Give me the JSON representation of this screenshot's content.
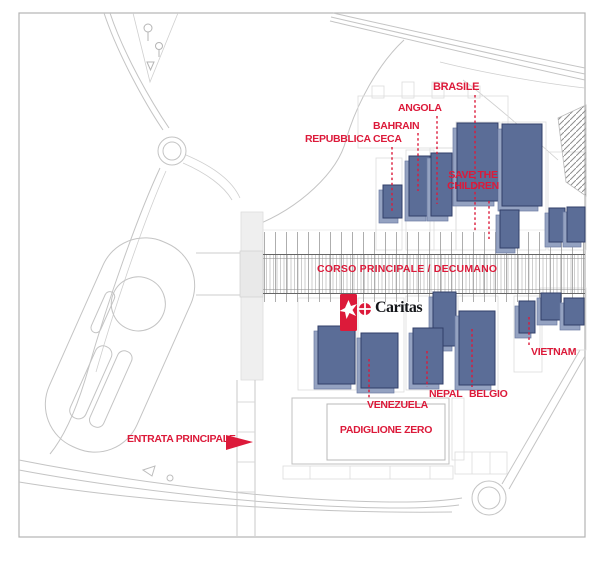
{
  "map": {
    "title_context": "Expo site plan",
    "labels": {
      "brasile": "BRASILE",
      "angola": "ANGOLA",
      "bahrain": "BAHRAIN",
      "repubblica_ceca": "REPUBBLICA CECA",
      "save_the_children": "SAVE THE CHILDREN",
      "corso_principale": "CORSO PRINCIPALE / DECUMANO",
      "vietnam": "VIETNAM",
      "nepal": "NEPAL",
      "belgio": "BELGIO",
      "venezuela": "VENEZUELA",
      "padiglione_zero": "PADIGLIONE ZERO",
      "entrata_principale": "ENTRATA PRINCIPALE",
      "caritas_logo": "Caritas"
    },
    "icons": {
      "caritas_marker": "dove-icon",
      "caritas_emblem": "caritas-cross-icon",
      "entrance_arrow": "arrow-right-icon"
    },
    "colors": {
      "label_red": "#dc1a3a",
      "building_fill": "#5b6d97",
      "building_light": "#94a2c1",
      "building_stroke": "#313f68",
      "road_gray": "#c4c4c4",
      "border_gray": "#b3b3b3"
    }
  }
}
